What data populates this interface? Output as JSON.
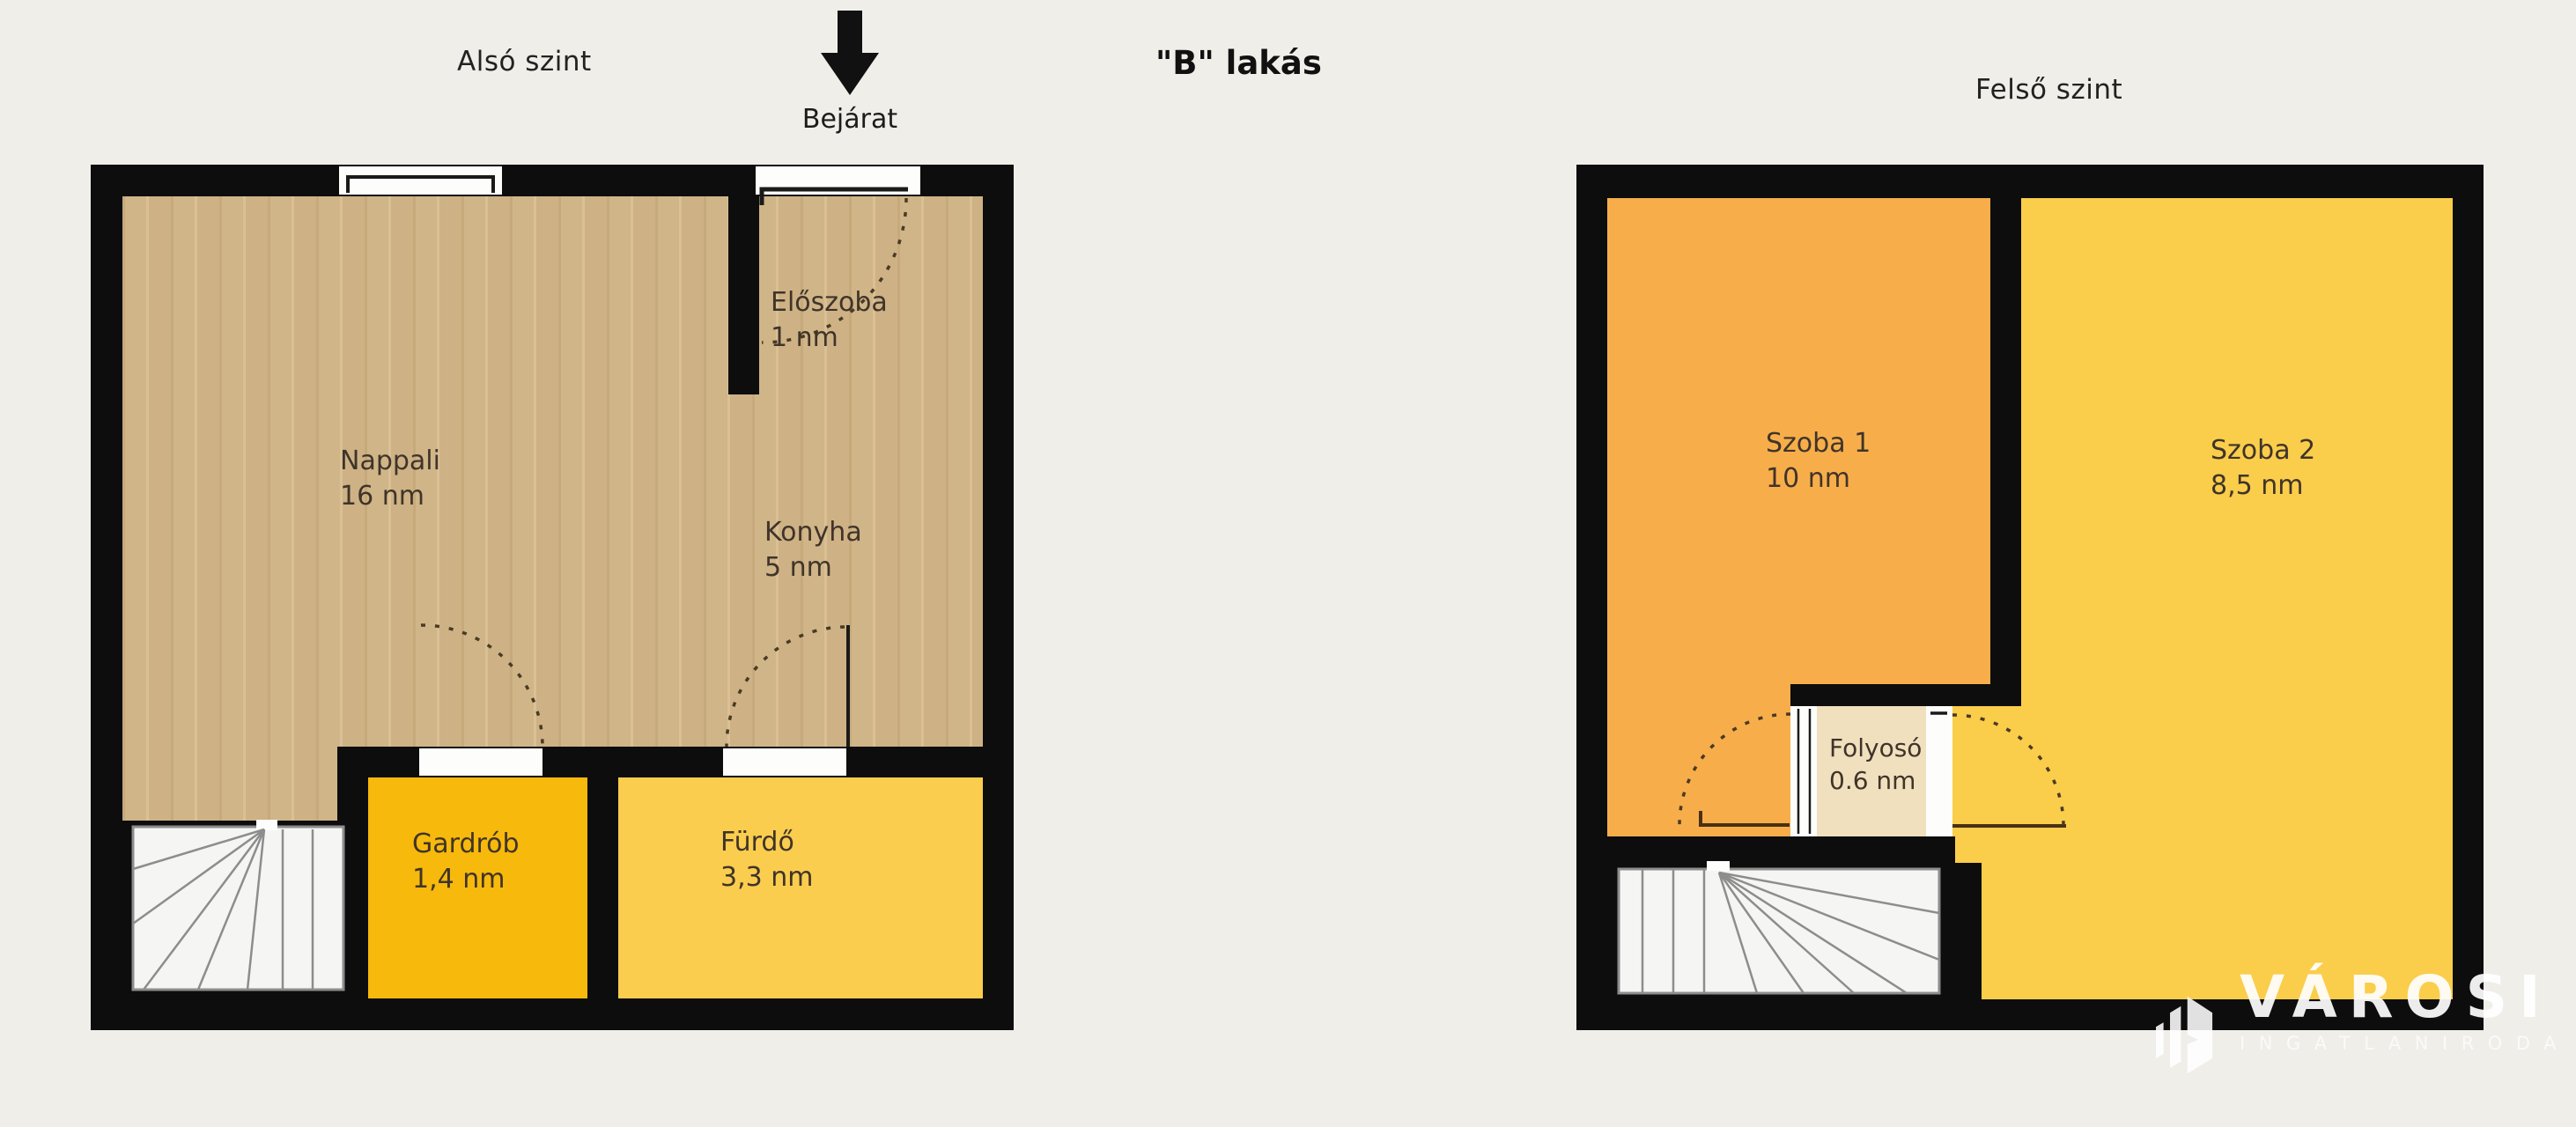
{
  "title": "\"B\" lakás",
  "header": {
    "left_plan_label": "Alsó szint",
    "right_plan_label": "Felső szint",
    "entrance_label": "Bejárat",
    "entrance_arrow_icon": "arrow-down-icon"
  },
  "floors": {
    "lower": {
      "name": "Alsó szint",
      "rooms": [
        {
          "name": "Nappali",
          "area": "16 nm"
        },
        {
          "name": "Előszoba",
          "area": "1 nm"
        },
        {
          "name": "Konyha",
          "area": "5 nm"
        },
        {
          "name": "Gardrób",
          "area": "1,4 nm"
        },
        {
          "name": "Fürdő",
          "area": "3,3 nm"
        }
      ],
      "features": [
        "stairs",
        "entrance-door",
        "window"
      ]
    },
    "upper": {
      "name": "Felső szint",
      "rooms": [
        {
          "name": "Szoba 1",
          "area": "10 nm"
        },
        {
          "name": "Szoba 2",
          "area": "8,5 nm"
        },
        {
          "name": "Folyosó",
          "area": "0.6 nm"
        }
      ],
      "features": [
        "stairs"
      ]
    }
  },
  "logo": {
    "brand": "VÁROSI",
    "tagline": "INGATLANIRODA"
  },
  "colors": {
    "background": "#F0EEE9",
    "wall": "#0D0D0D",
    "wood_floor": "#CFB487",
    "gardrob_fill": "#F7B90B",
    "furdo_fill": "#FACD4E",
    "szoba1_fill": "#F7AE4A",
    "szoba2_fill": "#FACD4B",
    "folyoso_fill": "#F0E0BE",
    "stairs_fill": "#F5F5F4",
    "label_text": "#40342A",
    "logo_text": "#FFFFFF"
  }
}
